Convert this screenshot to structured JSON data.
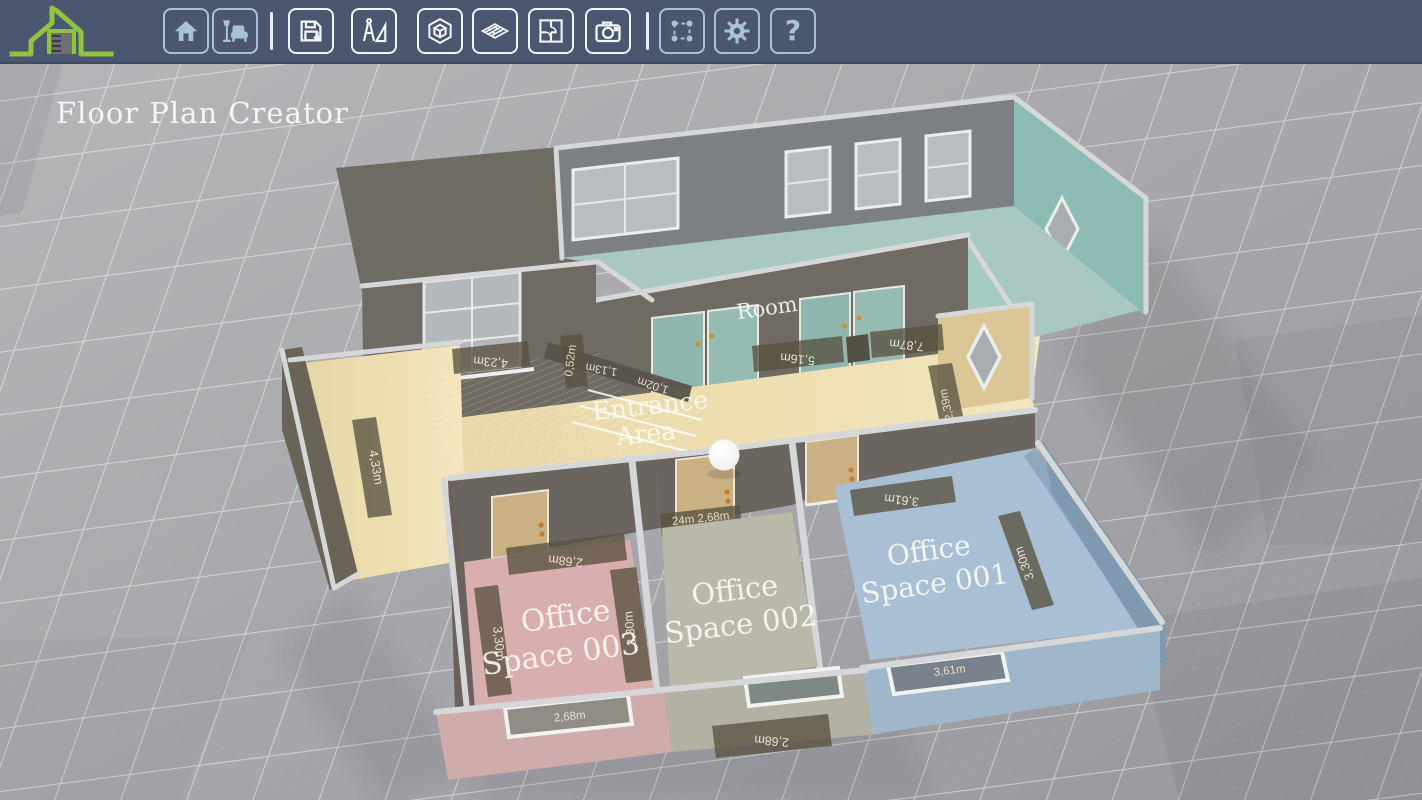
{
  "app": {
    "title": "Floor Plan Creator"
  },
  "toolbar": {
    "buttons": [
      {
        "id": "home",
        "icon": "home-icon"
      },
      {
        "id": "furniture",
        "icon": "furniture-icon"
      },
      {
        "id": "save",
        "icon": "save-icon"
      },
      {
        "id": "drafting",
        "icon": "drafting-tools-icon"
      },
      {
        "id": "view-3d",
        "icon": "cube-3d-icon"
      },
      {
        "id": "walls",
        "icon": "brick-wall-icon"
      },
      {
        "id": "floor-plan",
        "icon": "floor-plan-icon"
      },
      {
        "id": "camera",
        "icon": "camera-icon"
      },
      {
        "id": "select",
        "icon": "selection-icon"
      },
      {
        "id": "settings",
        "icon": "gear-icon"
      },
      {
        "id": "help",
        "icon": "help-icon",
        "glyph": "?"
      }
    ]
  },
  "scene": {
    "labels": {
      "room": "Room",
      "entrance_line1": "Entrance",
      "entrance_line2": "Area",
      "office1_line1": "Office",
      "office1_line2": "Space 001",
      "office2_line1": "Office",
      "office2_line2": "Space 002",
      "office3_line1": "Office",
      "office3_line2": "Space 003"
    },
    "dimensions": {
      "entrance_top": "4,23m",
      "entrance_gap": "0,52m",
      "door_width": "1,13m",
      "door_depth": "1,02m",
      "entrance_left": "4,33m",
      "room_south_left": "5,16m",
      "room_south_right": "7,87m",
      "corridor_depth": "2,39m",
      "office1_width": "3,61m",
      "office1_depth": "3,30m",
      "office1_window": "3,61m",
      "office2_door": "24m 2,68m",
      "office2_window_ground": "2,68m",
      "office3_width": "2,68m",
      "office3_depth_left": "3,30m",
      "office3_depth_right": "3,30m",
      "office3_window": "2,68m"
    }
  },
  "colors": {
    "toolbar_bg": "#4b5670",
    "icon_blue": "#a9c3d6",
    "icon_white": "#f2f5f8",
    "logo_green": "#8fc43c",
    "ground": "#a6a6aa",
    "entrance_floor": "#ecdcae",
    "room_floor": "#a9c8c1",
    "office1_floor": "#a9c0d4",
    "office2_floor": "#b9b8a9",
    "office3_floor": "#d9aeae",
    "wall_dark": "#6f6b62",
    "wall_cap": "#d6d7d9",
    "dim_strip": "#5e5947",
    "door_tan": "#c9b184"
  }
}
